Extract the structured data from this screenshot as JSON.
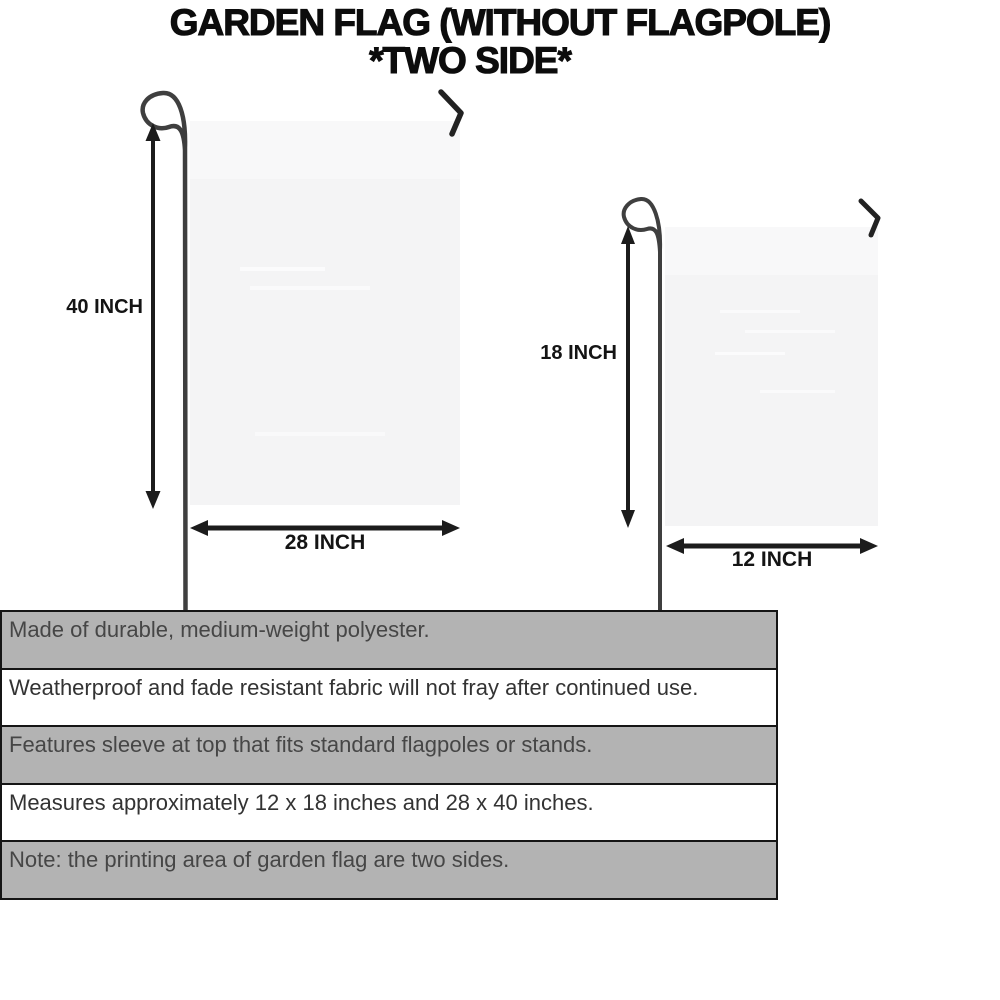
{
  "title": {
    "line1": "GARDEN FLAG (WITHOUT FLAGPOLE)",
    "line2": "*TWO SIDE*"
  },
  "diagram": {
    "large_flag": {
      "height_label": "40 INCH",
      "width_label": "28 INCH"
    },
    "small_flag": {
      "height_label": "18 INCH",
      "width_label": "12 INCH"
    }
  },
  "features": {
    "rows": [
      {
        "text": "Made of durable, medium-weight polyester.",
        "shaded": true
      },
      {
        "text": "Weatherproof and fade resistant fabric will not fray after continued use.",
        "shaded": false
      },
      {
        "text": "Features sleeve at top that fits standard flagpoles or stands.",
        "shaded": true
      },
      {
        "text": "Measures approximately 12 x 18 inches and 28 x 40 inches.",
        "shaded": false
      },
      {
        "text": "Note: the printing area of garden flag are two sides.",
        "shaded": true
      }
    ]
  },
  "colors": {
    "row_shade": "#b3b3b3",
    "row_border": "#151515",
    "flag_fill": "#f4f4f5",
    "flag_sleeve": "#f8f8f9",
    "pole": "#3f3f3f",
    "arrow": "#1c1c1c",
    "title_text": "#0c0c0c",
    "feature_text": "#333333"
  }
}
